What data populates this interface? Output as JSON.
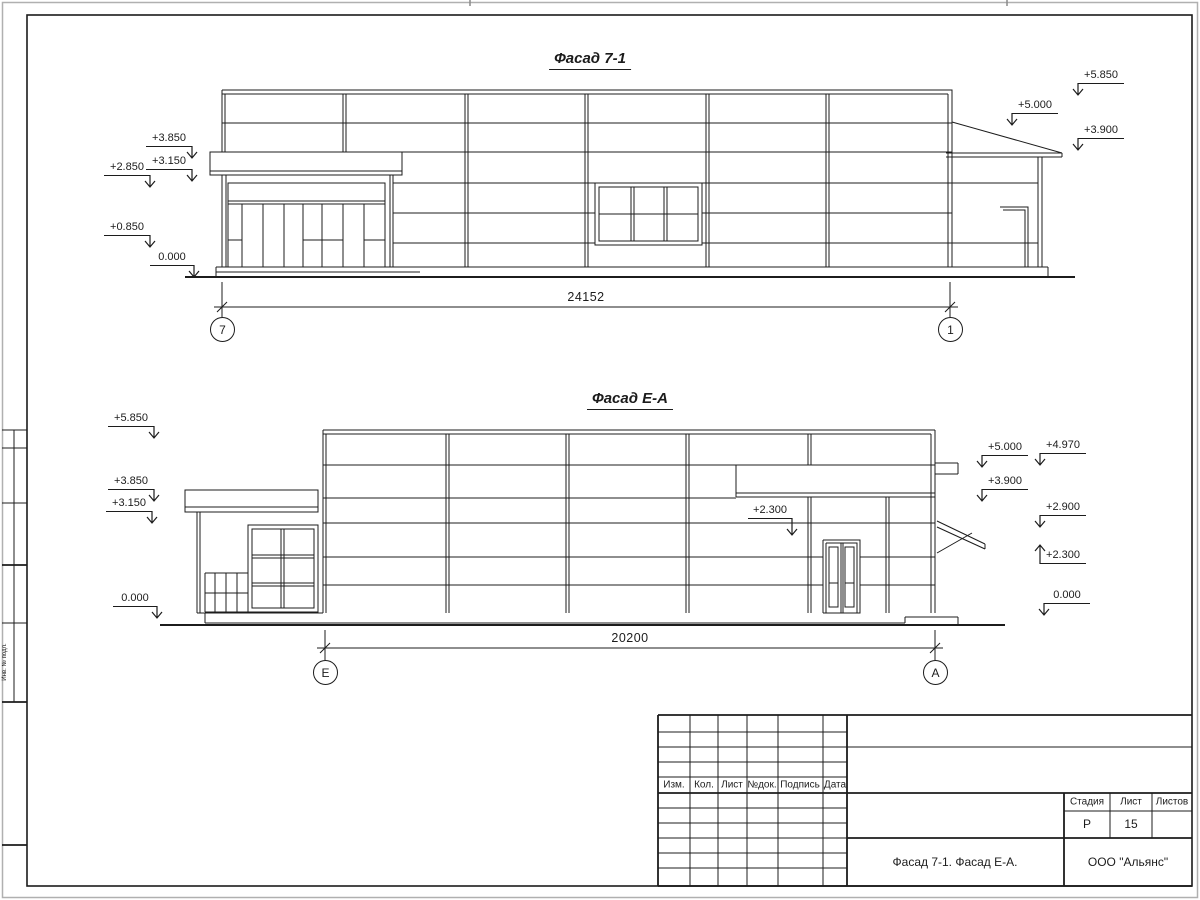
{
  "page": {
    "line_color": "#1c1c1c",
    "edge_color": "#b0b0b0",
    "background": "#ffffff"
  },
  "facade1": {
    "title": "Фасад 7-1",
    "dimension": "24152",
    "axis_left": "7",
    "axis_right": "1",
    "marks": [
      {
        "label": "+3.850",
        "x1": 146,
        "x2": 192,
        "y": 147,
        "arrow": "right"
      },
      {
        "label": "+3.150",
        "x1": 146,
        "x2": 192,
        "y": 170,
        "arrow": "right"
      },
      {
        "label": "+2.850",
        "x1": 104,
        "x2": 150,
        "y": 176,
        "arrow": "right"
      },
      {
        "label": "+0.850",
        "x1": 104,
        "x2": 150,
        "y": 236,
        "arrow": "right"
      },
      {
        "label": "0.000",
        "x1": 150,
        "x2": 194,
        "y": 266,
        "arrow": "right"
      },
      {
        "label": "+5.850",
        "x1": 1078,
        "x2": 1124,
        "y": 84,
        "arrow": "left"
      },
      {
        "label": "+5.000",
        "x1": 1012,
        "x2": 1058,
        "y": 114,
        "arrow": "left"
      },
      {
        "label": "+3.900",
        "x1": 1078,
        "x2": 1124,
        "y": 139,
        "arrow": "left"
      }
    ]
  },
  "facade2": {
    "title": "Фасад Е-А",
    "dimension": "20200",
    "axis_left": "Е",
    "axis_right": "А",
    "marks": [
      {
        "label": "+5.850",
        "x1": 108,
        "x2": 154,
        "y": 427,
        "arrow": "right"
      },
      {
        "label": "+3.850",
        "x1": 108,
        "x2": 154,
        "y": 490,
        "arrow": "right"
      },
      {
        "label": "+3.150",
        "x1": 106,
        "x2": 152,
        "y": 512,
        "arrow": "right"
      },
      {
        "label": "0.000",
        "x1": 113,
        "x2": 157,
        "y": 607,
        "arrow": "right"
      },
      {
        "label": "+2.300",
        "x1": 748,
        "x2": 792,
        "y": 519,
        "arrow": "right",
        "leader": 18
      },
      {
        "label": "+5.000",
        "x1": 982,
        "x2": 1028,
        "y": 456,
        "arrow": "left"
      },
      {
        "label": "+3.900",
        "x1": 982,
        "x2": 1028,
        "y": 490,
        "arrow": "left"
      },
      {
        "label": "+4.970",
        "x1": 1040,
        "x2": 1086,
        "y": 454,
        "arrow": "left"
      },
      {
        "label": "+2.900",
        "x1": 1040,
        "x2": 1086,
        "y": 516,
        "arrow": "left"
      },
      {
        "label": "+2.300",
        "x1": 1040,
        "x2": 1086,
        "y": 564,
        "arrow": "left",
        "dir": "up",
        "leader": 20
      },
      {
        "label": "0.000",
        "x1": 1044,
        "x2": 1090,
        "y": 604,
        "arrow": "left"
      }
    ]
  },
  "title_block": {
    "columns": [
      "Изм.",
      "Кол.",
      "Лист",
      "№док.",
      "Подпись",
      "Дата"
    ],
    "stage_label": "Стадия",
    "sheet_label": "Лист",
    "sheets_label": "Листов",
    "stage_value": "Р",
    "sheet_value": "15",
    "sheets_value": "",
    "drawing_title": "Фасад 7-1. Фасад Е-А.",
    "company": "ООО \"Альянс\""
  },
  "side_stamp": {
    "label": "Инв. № подл."
  }
}
